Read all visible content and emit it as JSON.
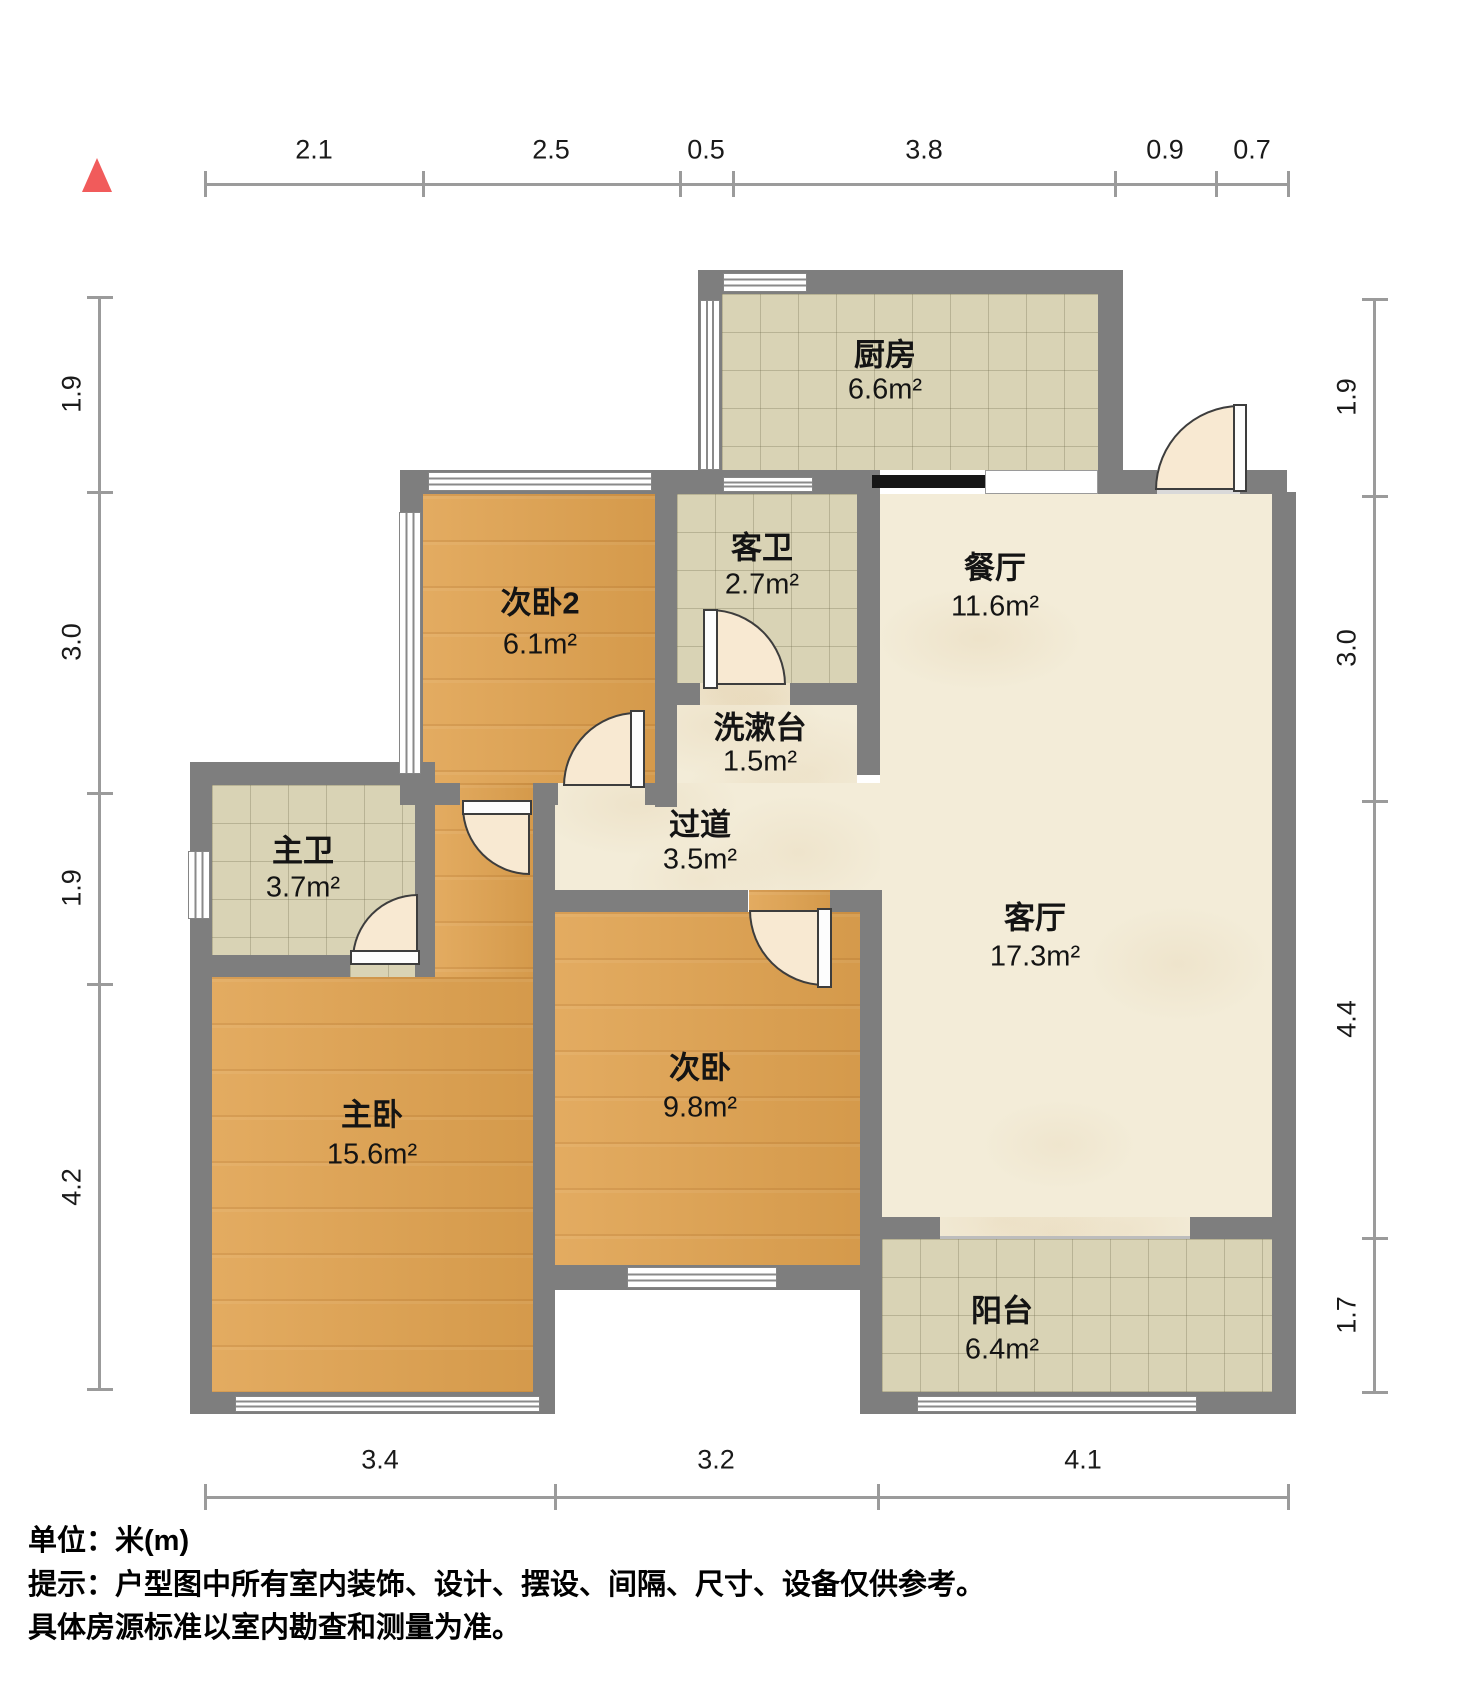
{
  "compass": {
    "label": "north",
    "color": "#f15b5b"
  },
  "dimensions": {
    "top": [
      "2.1",
      "2.5",
      "0.5",
      "3.8",
      "0.9",
      "0.7"
    ],
    "left": [
      "1.9",
      "3.0",
      "1.9",
      "4.2"
    ],
    "right": [
      "1.9",
      "3.0",
      "4.4",
      "1.7"
    ],
    "bottom": [
      "3.4",
      "3.2",
      "4.1"
    ]
  },
  "rooms": [
    {
      "id": "kitchen",
      "name": "厨房",
      "area": "6.6m²",
      "floor": "tile"
    },
    {
      "id": "bedroom2",
      "name": "次卧2",
      "area": "6.1m²",
      "floor": "wood"
    },
    {
      "id": "guest-bath",
      "name": "客卫",
      "area": "2.7m²",
      "floor": "tile"
    },
    {
      "id": "dining",
      "name": "餐厅",
      "area": "11.6m²",
      "floor": "marble"
    },
    {
      "id": "washstand",
      "name": "洗漱台",
      "area": "1.5m²",
      "floor": "marble"
    },
    {
      "id": "hallway",
      "name": "过道",
      "area": "3.5m²",
      "floor": "marble"
    },
    {
      "id": "master-bath",
      "name": "主卫",
      "area": "3.7m²",
      "floor": "tile"
    },
    {
      "id": "master-bedroom",
      "name": "主卧",
      "area": "15.6m²",
      "floor": "wood"
    },
    {
      "id": "bedroom",
      "name": "次卧",
      "area": "9.8m²",
      "floor": "wood"
    },
    {
      "id": "living",
      "name": "客厅",
      "area": "17.3m²",
      "floor": "marble"
    },
    {
      "id": "balcony",
      "name": "阳台",
      "area": "6.4m²",
      "floor": "tile"
    }
  ],
  "footer": {
    "unit": "单位：米(m)",
    "tip1": "提示：户型图中所有室内装饰、设计、摆设、间隔、尺寸、设备仅供参考。",
    "tip2": "具体房源标准以室内勘查和测量为准。"
  },
  "colors": {
    "wall": "#7e7e7e",
    "wood": "#e0a24f",
    "tile": "#d9d3b5",
    "marble": "#f3ecd8",
    "dim_line": "#9b9b9b",
    "door_swing": "#f8e9d2",
    "threshold": "#d9d9d9",
    "slide_bar": "#161616"
  }
}
